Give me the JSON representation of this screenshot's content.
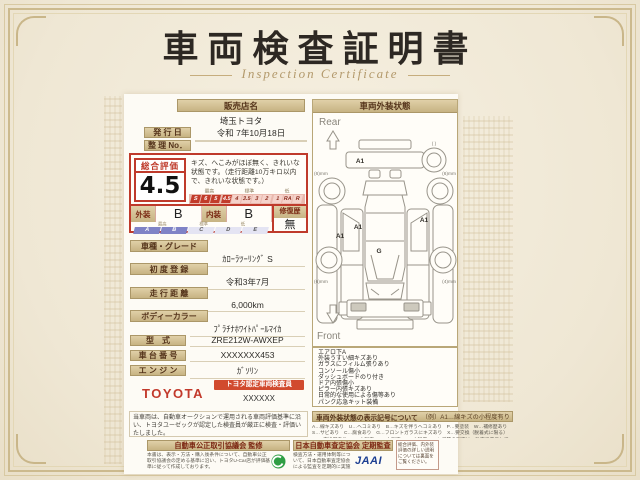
{
  "page": {
    "title": "車両検査証明書",
    "subtitle": "Inspection Certificate"
  },
  "dealer": {
    "header": "販売店名",
    "name": "埼玉トヨタ"
  },
  "issue": {
    "label": "発 行 日",
    "value": "令和 7年10月18日"
  },
  "ref": {
    "label": "整 理 No．",
    "value": ""
  },
  "evaluation": {
    "label": "総合評価",
    "score": "4.5",
    "comment": "キズ、へこみがほぼ無く、きれいな状態です。（走行距離10万キロ以内で、きれいな状態です。）",
    "scale": {
      "high": "最高",
      "mid": "標準",
      "low": "低",
      "cells": [
        "S",
        "6",
        "5",
        "4.5",
        "4",
        "3.5",
        "3",
        "2",
        "1",
        "RA",
        "R"
      ]
    },
    "exterior": {
      "label": "外装",
      "grade": "B"
    },
    "interior": {
      "label": "内装",
      "grade": "B"
    },
    "repair": {
      "label": "修復歴",
      "value": "無"
    },
    "grade_scale": {
      "high": "最高",
      "mid": "標準",
      "low": "低",
      "cells": [
        "A",
        "B",
        "C",
        "D",
        "E"
      ]
    }
  },
  "details": [
    {
      "label": "車種・グレード",
      "value": "ｶﾛｰﾗﾂｰﾘﾝｸﾞ S"
    },
    {
      "label": "初 度 登 録",
      "value": "令和3年7月"
    },
    {
      "label": "走 行 距 離",
      "value": "6,000km"
    },
    {
      "label": "ボディーカラー",
      "value": "ﾌﾟﾗﾁﾅﾎﾜｲﾄﾊﾟｰﾙﾏｲｶ"
    }
  ],
  "specs": [
    {
      "label": "型　式",
      "value": "ZRE212W-AWXEP"
    },
    {
      "label": "車 台 番 号",
      "value": "XXXXXXX453"
    },
    {
      "label": "エ ン ジ ン",
      "value": "ｶﾞｿﾘﾝ"
    }
  ],
  "certification": {
    "brand": "TOYOTA",
    "badge": "トヨタ認定車両検査員",
    "inspector_no": "XXXXXX"
  },
  "disclaimer": "当車両は、自動車オークションで運用される車両評価基準に沿い、トヨタユーゼックが認定した検査員が厳正に検査・評価いたしました。",
  "exterior_panel": {
    "header": "車両外装状態",
    "rear": "Rear",
    "front": "Front",
    "marks": {
      "rear_bumper": "A1",
      "left_quarter": "A1",
      "left_door": "A1",
      "right_door": "A1",
      "roof": "G",
      "spare": "(  )"
    },
    "treads": {
      "rear_left": "(6)mm",
      "rear_right": "(6)mm",
      "front_left": "(6)mm",
      "front_right": "(4)mm"
    },
    "equipment": [
      "エアロ下A",
      "外装うすい細キズあり",
      "ガラスにフィルム張りあり",
      "コンソール傷小",
      "ダッシュボードのり付き",
      "ドア内張傷小",
      "ピラー内張キズあり",
      "日常的な使用による傷等あり",
      "パンク応急キット装備"
    ],
    "legend": {
      "title": "車両外装状態の表示記号について",
      "example": "（例）A1…線キズの小程度有り",
      "body": "A…線キズあり　U…ヘコミあり　B…キズを伴うヘコミあり　P…要塗装　W…補修歴あり　S…サビあり　C…腐食あり　G…フロントガラスにキズあり　X…要交換（脱着式に限る）　XX…交換歴あり　1…小程度　2…中程度　3…大程度　・キズ等の程度は、数字で表示しています。"
    }
  },
  "footer": {
    "fair_trade": {
      "title": "自動車公正取引協議会 監修",
      "body": "本書は、表示・方法・購入後条件について、自動車公正取引協議会の定める基準に沿い、トヨタU-Car店が評価基準に従って作成しております。"
    },
    "jaai": {
      "title": "日本自動車査定協会 定期監査",
      "body": "検査方法・運用体制等について、日本自動車査定協会による監査を定期的に実施しています。",
      "logo": "JAAI"
    },
    "note": "総合評価、内外装評価の詳しい説明については裏面をご覧ください。"
  },
  "colors": {
    "accent_red": "#bf3a2b",
    "bar_tan": "#c7b383",
    "grade_blue": "#7f83c6",
    "jaai_blue": "#1d3f92",
    "toyota_red": "#c2392b"
  }
}
